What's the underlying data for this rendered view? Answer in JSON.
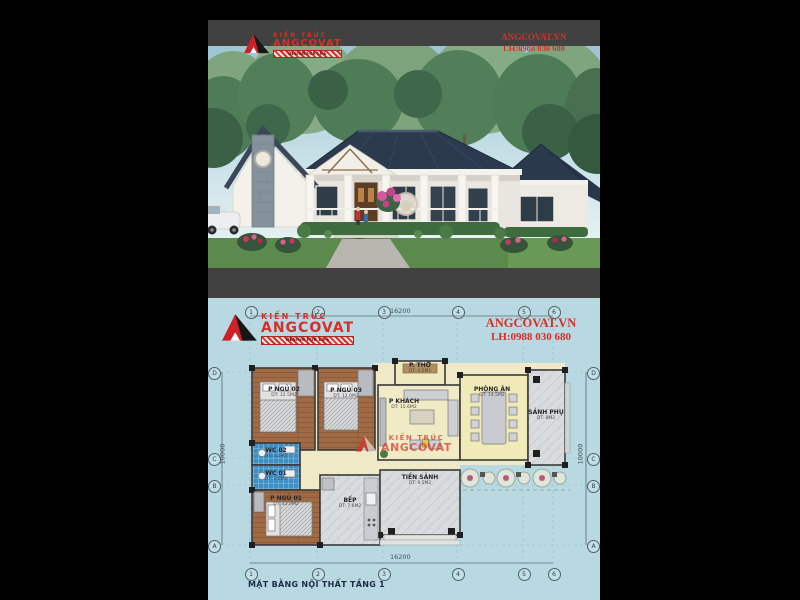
{
  "branding": {
    "kien_truc": "KIẾN TRÚC",
    "angcovat": "ANGCOVAT",
    "tagline": "DESIGN FOR LIFE",
    "website": "ANGCOVAT.VN",
    "phone": "LH:0988 030 680",
    "accent_red": "#d62f28"
  },
  "plan": {
    "title": "MẶT BẰNG NỘI THẤT TẦNG 1",
    "dim_width": "16200",
    "dim_height": "10000",
    "grid_cols": [
      "1",
      "2",
      "3",
      "4",
      "5",
      "6"
    ],
    "grid_rows": [
      "D",
      "C",
      "B",
      "A"
    ],
    "rooms": [
      {
        "name": "P NGỦ 02",
        "area": "DT: 12.5M2"
      },
      {
        "name": "P NGỦ 03",
        "area": "DT: 12.0M2"
      },
      {
        "name": "P. THỜ",
        "area": "DT: 4.5M2"
      },
      {
        "name": "P KHÁCH",
        "area": "DT: 15.6M2"
      },
      {
        "name": "PHÒNG ĂN",
        "area": "DT: 14.5M2"
      },
      {
        "name": "SẢNH PHỤ",
        "area": "DT: 8M2"
      },
      {
        "name": "WC 02",
        "area": "DT: 3.2M2"
      },
      {
        "name": "WC 01",
        "area": "DT: 3.6M2"
      },
      {
        "name": "P NGỦ 01",
        "area": "DT: 13.0M2"
      },
      {
        "name": "BẾP",
        "area": "DT: 7.6M2"
      },
      {
        "name": "TIỀN SẢNH",
        "area": "DT: 9.5M2"
      }
    ]
  }
}
